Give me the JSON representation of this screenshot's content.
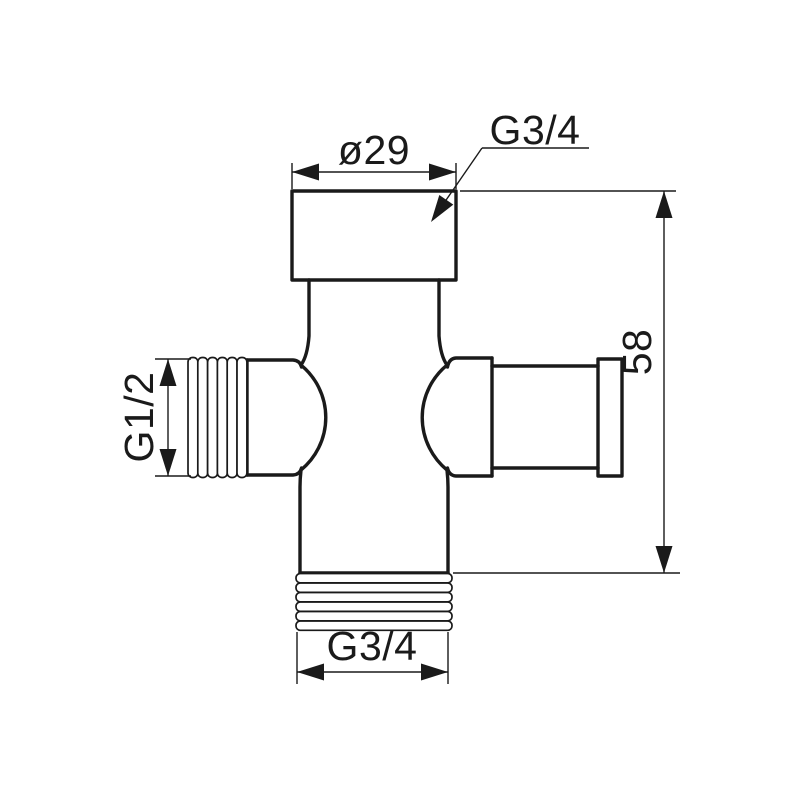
{
  "drawing": {
    "dimensions": {
      "top_diameter": "ø29",
      "top_thread": "G3/4",
      "left_thread": "G1/2",
      "bottom_thread": "G3/4",
      "overall_height": "58"
    },
    "colors": {
      "line": "#1a1a1a",
      "background": "#ffffff"
    }
  }
}
